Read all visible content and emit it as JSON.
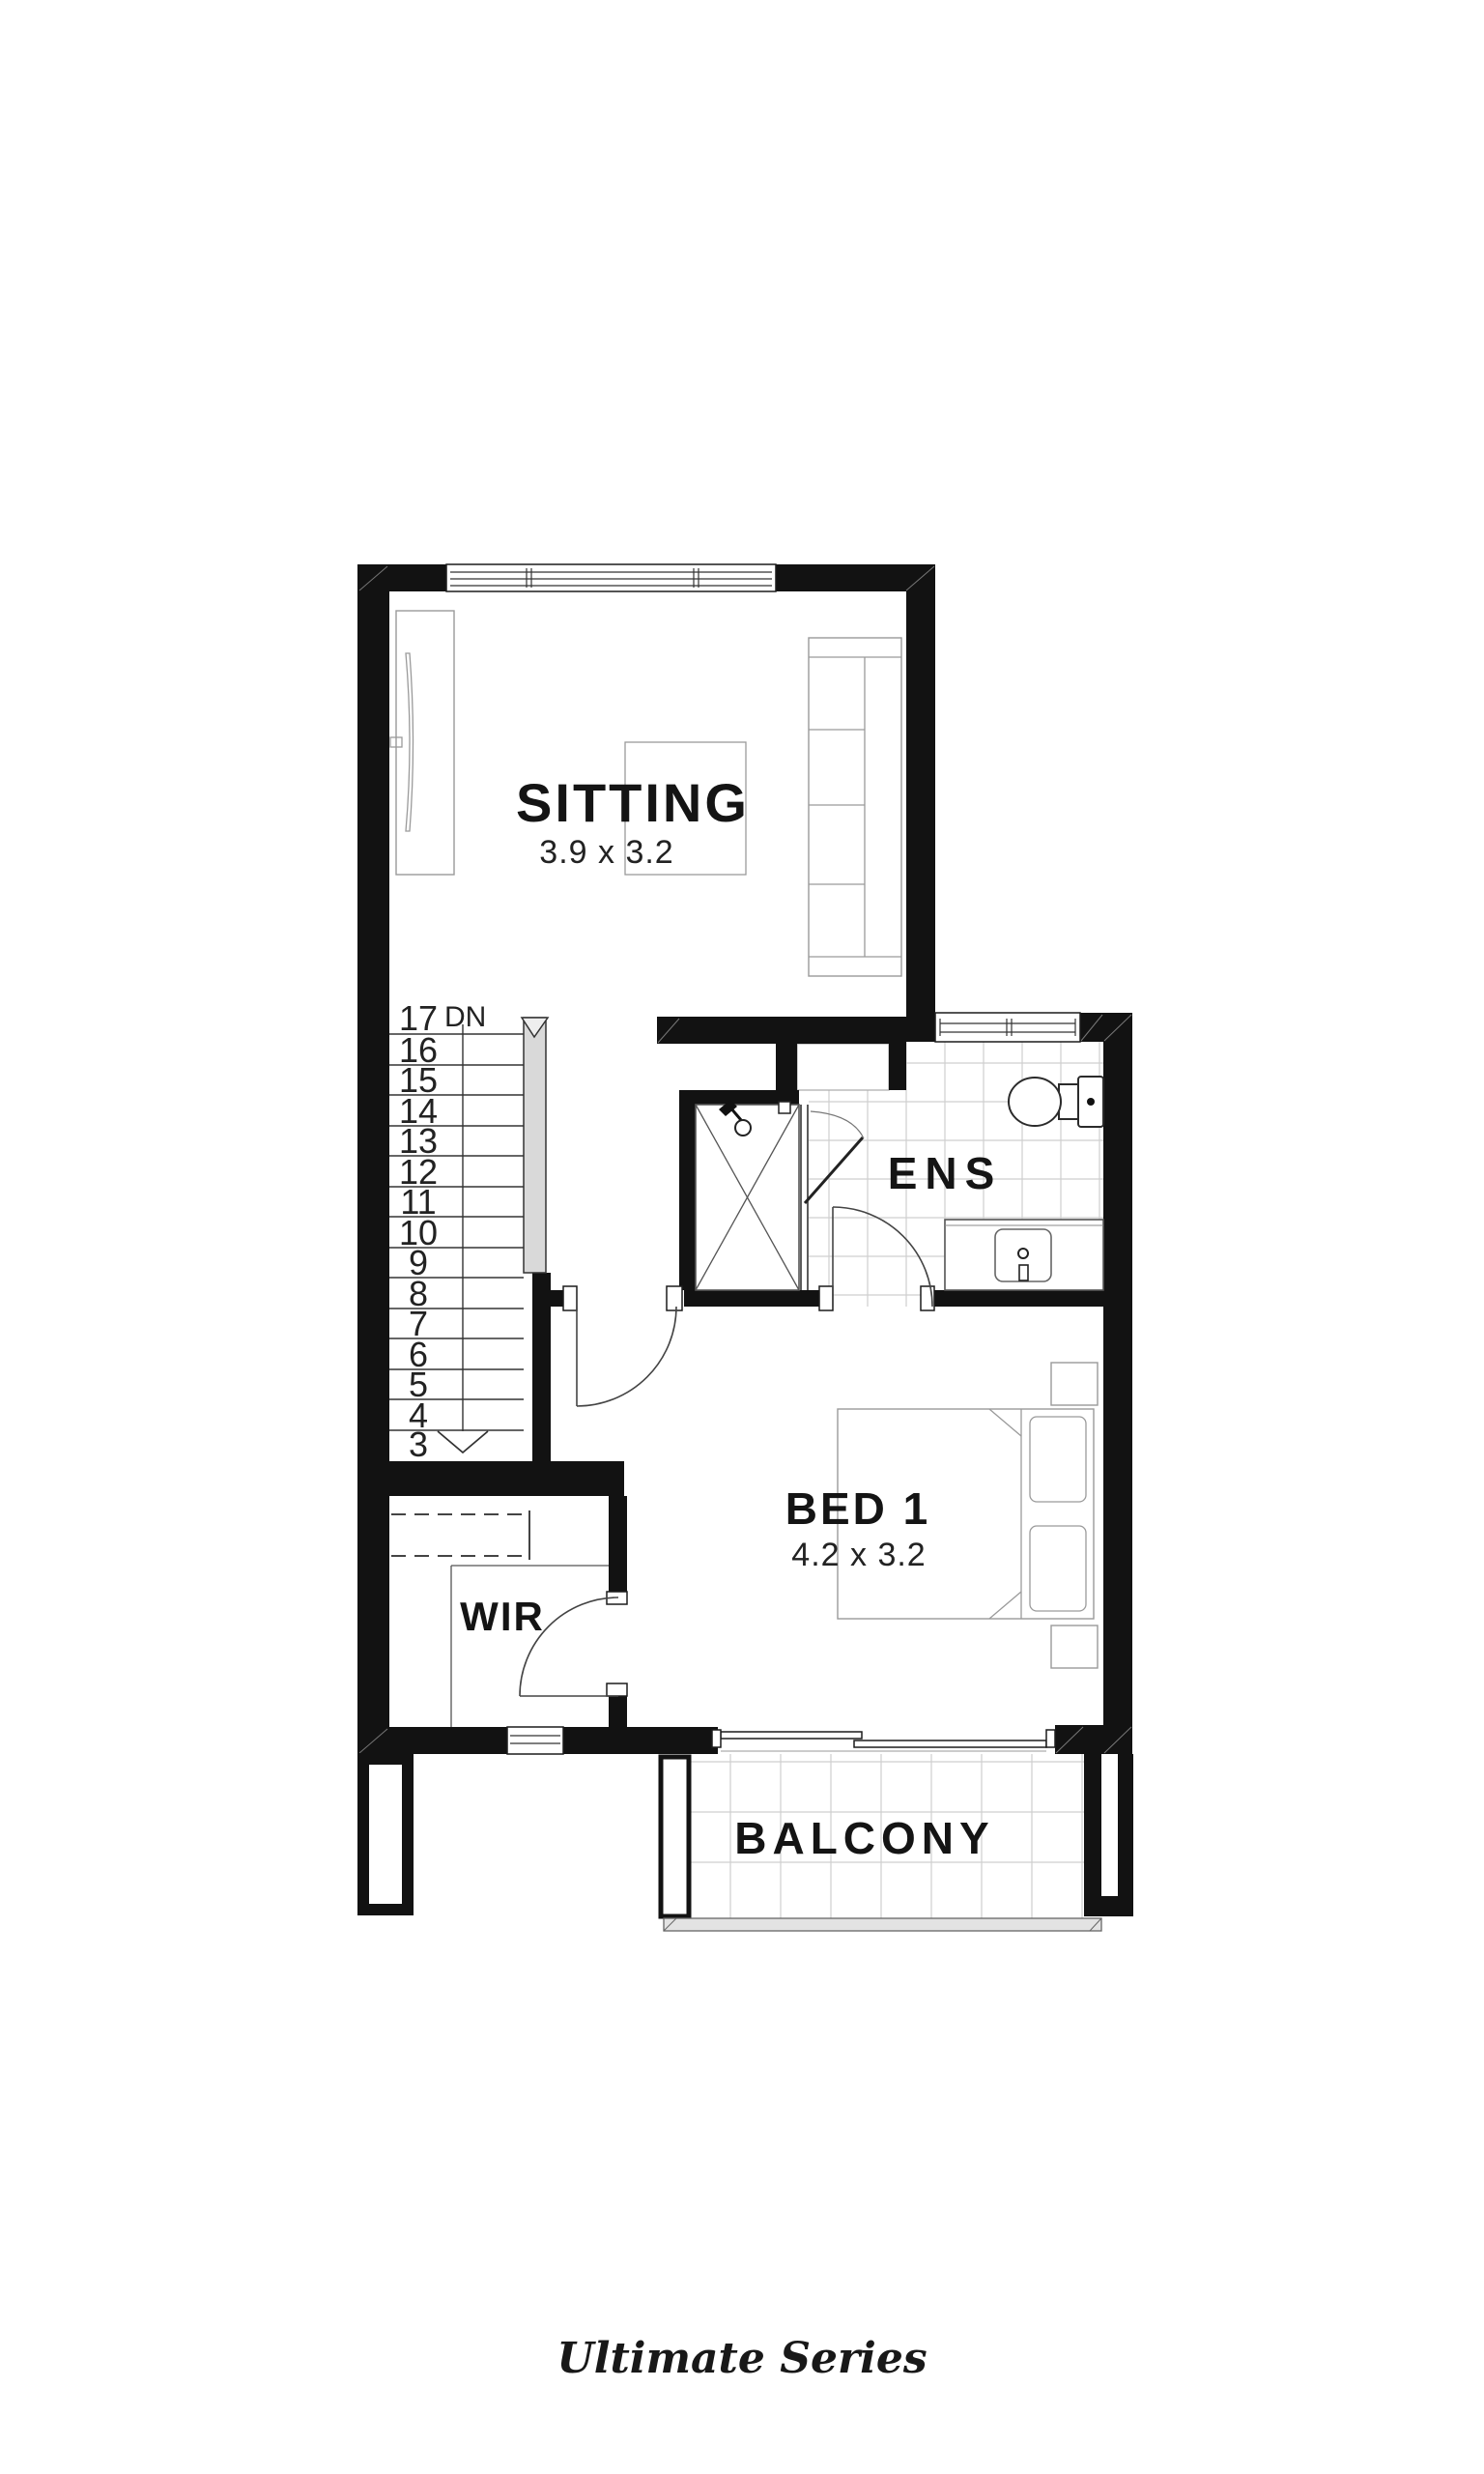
{
  "page": {
    "background": "#ffffff"
  },
  "branding": {
    "series_label": "Ultimate Series"
  },
  "plan": {
    "colors": {
      "wall": "#121212",
      "tile_line": "#cfcfcf",
      "furniture_line": "#9a9a9a",
      "rail_fill": "#d9d9d9",
      "balustrade_fill": "#e3e3e3"
    },
    "rooms": {
      "sitting": {
        "label": "SITTING",
        "dimensions": "3.9 x 3.2"
      },
      "ens": {
        "label": "ENS"
      },
      "bed1": {
        "label": "BED 1",
        "dimensions": "4.2 x 3.2"
      },
      "wir": {
        "label": "WIR"
      },
      "balcony": {
        "label": "BALCONY"
      }
    },
    "stairs": {
      "down_label": "DN",
      "treads": [
        "17",
        "16",
        "15",
        "14",
        "13",
        "12",
        "11",
        "10",
        "9",
        "8",
        "7",
        "6",
        "5",
        "4",
        "3"
      ]
    }
  }
}
